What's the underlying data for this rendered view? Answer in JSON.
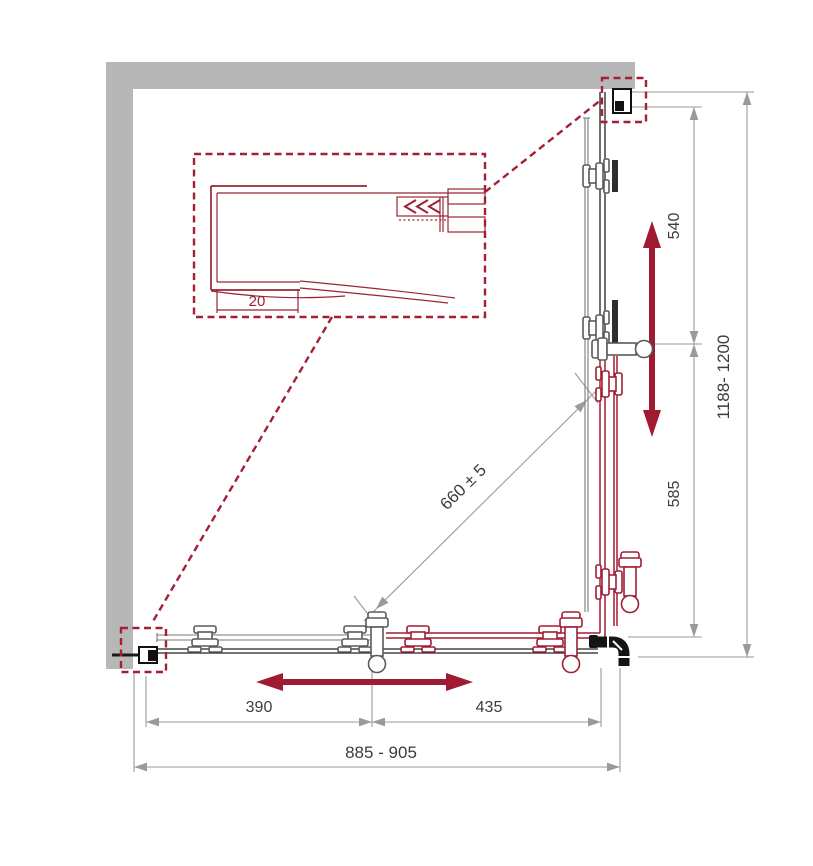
{
  "colors": {
    "accent_red": "#9E1B32",
    "drawing_red": "#9B2433",
    "wall_gray": "#B7B7B7",
    "dim_line_gray": "#9A9A9A",
    "dim_text_gray": "#3C3C3C",
    "hardware_black": "#1A1A1A"
  },
  "detail_view": {
    "profile_width_label": "20"
  },
  "dimensions": {
    "upper_side_panel": "540",
    "lower_side_panel": "585",
    "side_overall": "1188- 1200",
    "diagonal_entry": "660 ± 5",
    "front_left_panel": "390",
    "front_right_panel": "435",
    "front_overall": "885 - 905"
  }
}
